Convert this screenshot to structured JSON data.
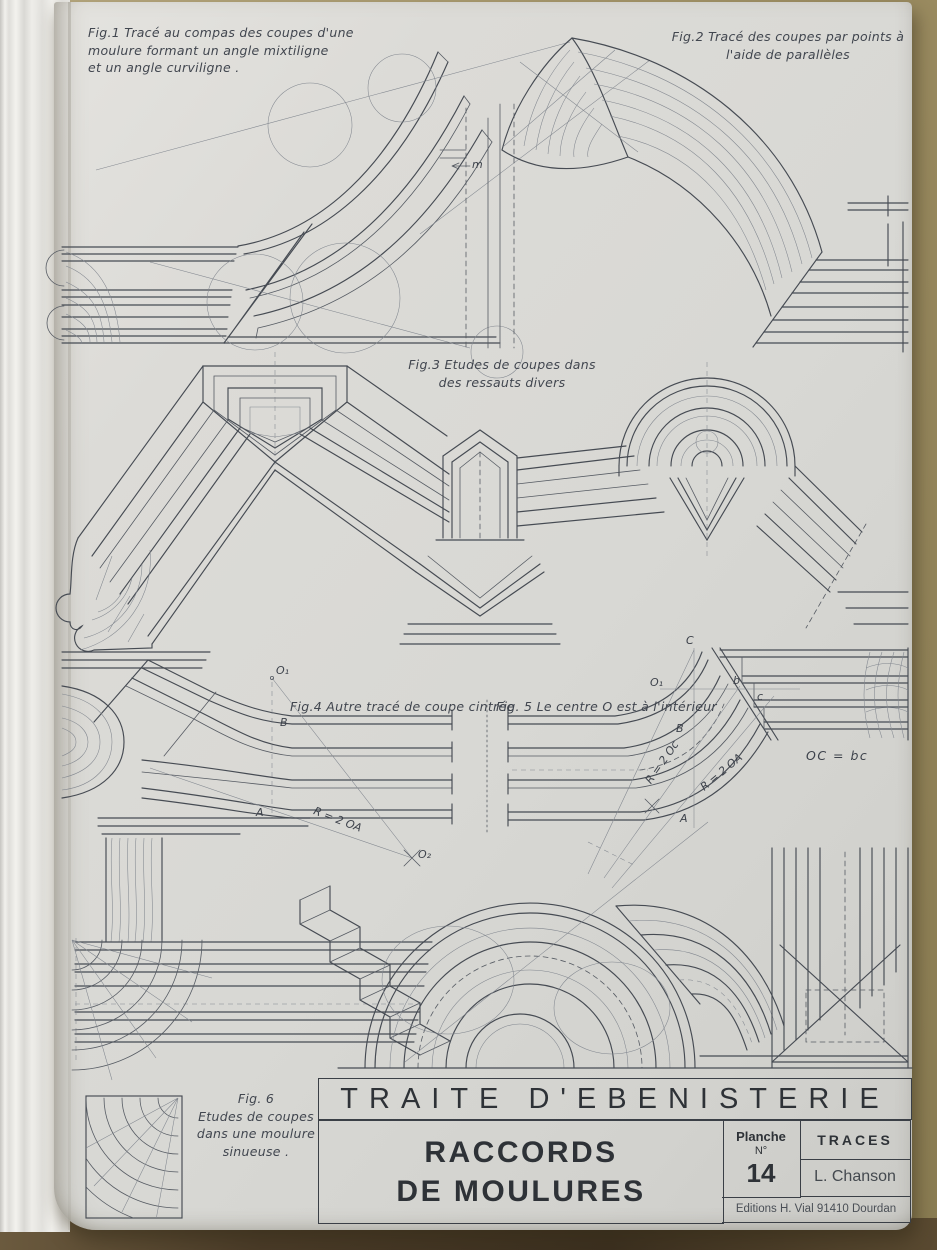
{
  "figures": {
    "fig1": {
      "caption": "Fig.1   Tracé au compas des coupes d'une\nmoulure formant un angle mixtiligne\net un angle curviligne ."
    },
    "fig2": {
      "caption": "Fig.2   Tracé des coupes par points à\nl'aide de parallèles"
    },
    "fig3": {
      "caption": "Fig.3   Etudes de coupes dans\ndes ressauts divers"
    },
    "fig4": {
      "caption": "Fig.4  Autre tracé de coupe cintrée",
      "labels": {
        "o1": "O₁",
        "b": "B",
        "a": "A",
        "radius": "R = 2 OA",
        "o2": "O₂"
      }
    },
    "fig5": {
      "caption": "Fig. 5  Le centre O est à l'intérieur",
      "labels": {
        "c": "C",
        "o1": "O₁",
        "b": "b",
        "c_point": "c",
        "b_cap": "B",
        "a": "A",
        "radius_oc": "R = 2 Oc",
        "radius_oa": "R = 2 OA",
        "equation": "OC = bc"
      }
    },
    "fig6": {
      "caption": "Fig. 6\nEtudes de coupes\ndans une moulure\nsinueuse ."
    }
  },
  "annotations": {
    "m_point": "m"
  },
  "title_block": {
    "series_title": "TRAITE  D'EBENISTERIE",
    "plate_title_line1": "RACCORDS",
    "plate_title_line2": "DE MOULURES",
    "plate_label": "Planche",
    "plate_number_label": "N°",
    "plate_number": "14",
    "section": "TRACES",
    "author": "L. Chanson",
    "publisher": "Editions H. Vial  91410 Dourdan"
  },
  "colors": {
    "paper": "#d9d8d3",
    "ink": "#464b53",
    "construction": "#82878f",
    "desk": "#a99a6f",
    "shadow": "#473927"
  }
}
